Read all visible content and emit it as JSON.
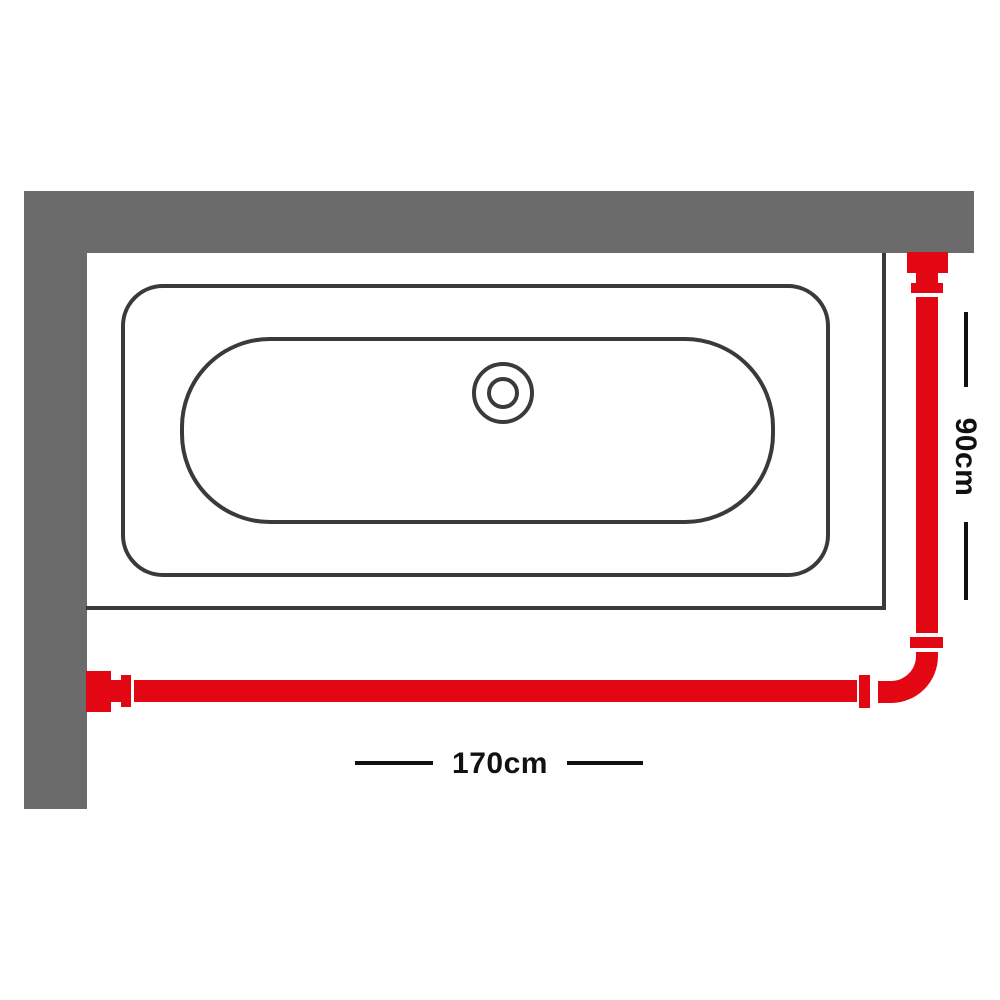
{
  "diagram": {
    "title": "l-shaped-shower-curtain-rail-installation-top-view",
    "dimensions": {
      "width_label": "170cm",
      "height_label": "90cm"
    },
    "colors": {
      "rail": "#e30613",
      "wall": "#6b6b6b",
      "outline": "#3a3a3a",
      "dimension": "#111111",
      "background": "#ffffff"
    }
  }
}
